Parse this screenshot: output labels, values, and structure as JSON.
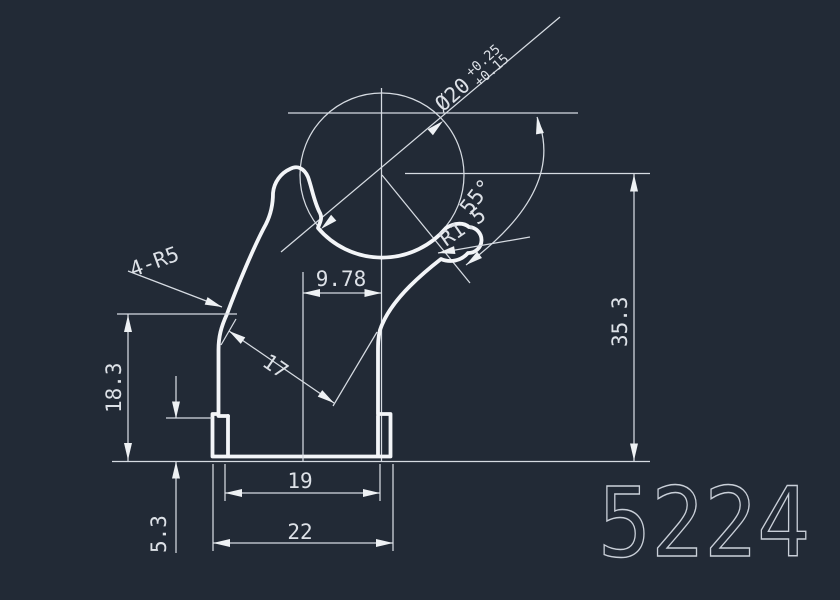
{
  "drawing": {
    "type": "cad-profile-cross-section",
    "part_number": "5224",
    "colors": {
      "background": "#222a36",
      "profile_line": "#f3f5f8",
      "dimension_line": "#d6dbe2",
      "dimension_text": "#dde1e7",
      "part_number_text": "#c9cfd8"
    },
    "dimensions": {
      "diameter": "Ø20",
      "diameter_tol_upper": "+0.25",
      "diameter_tol_lower": "+0.15",
      "angle": "55°",
      "tip_radius": "R1.5",
      "fillet_note": "4-R5",
      "center_offset": "9.78",
      "slope_width": "17",
      "left_height": "18.3",
      "right_height": "35.3",
      "base_height": "5.3",
      "inner_width": "19",
      "outer_width": "22"
    }
  }
}
